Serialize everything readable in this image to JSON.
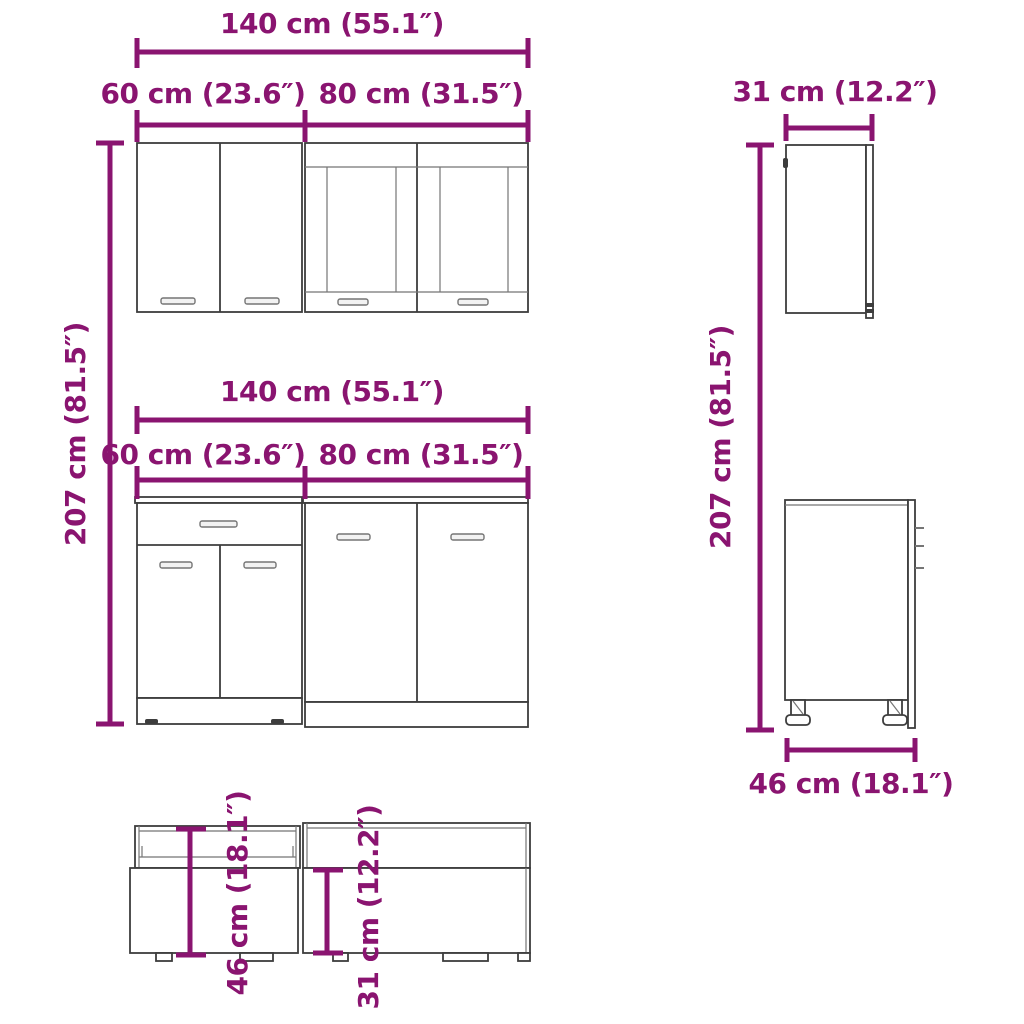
{
  "colors": {
    "dimension": "#8A1470",
    "outline": "#3d3d3d",
    "outline_light": "#757575"
  },
  "labels": {
    "wall_total_width": "140 cm (55.1″)",
    "wall_left_width": "60 cm (23.6″)",
    "wall_right_width": "80 cm (31.5″)",
    "base_total_width": "140 cm (55.1″)",
    "base_left_width": "60 cm (23.6″)",
    "base_right_width": "80 cm (31.5″)",
    "left_height": "207 cm (81.5″)",
    "right_height": "207 cm (81.5″)",
    "wall_side_depth": "31 cm (12.2″)",
    "base_side_depth": "46 cm (18.1″)",
    "top_view_base_depth": "46 cm (18.1″)",
    "top_view_wall_depth": "31 cm (12.2″)"
  }
}
